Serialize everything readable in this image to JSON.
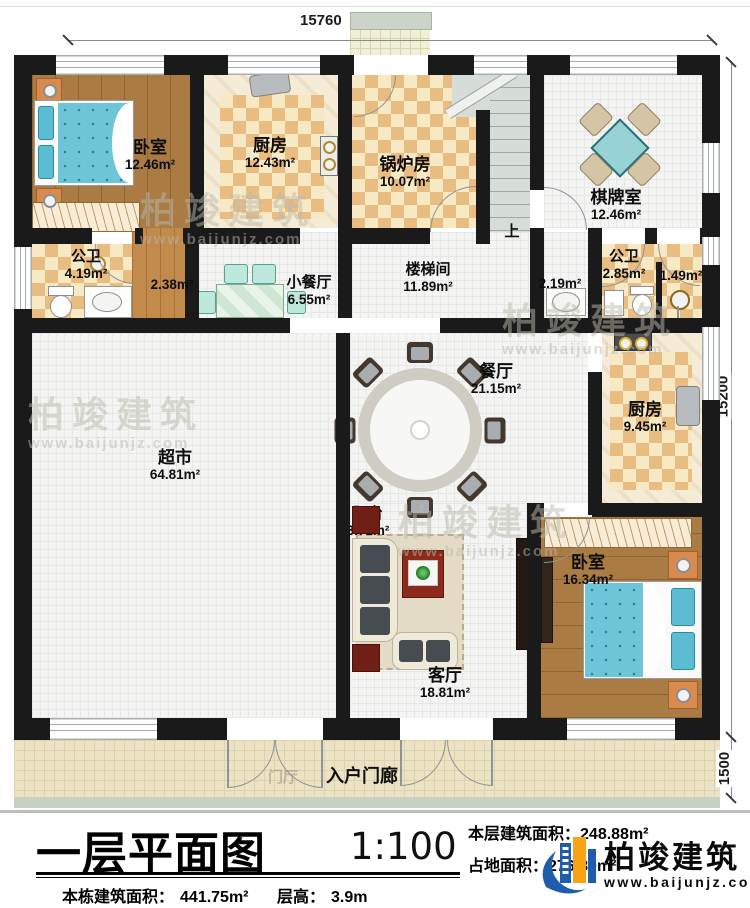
{
  "dims": {
    "top": "15760",
    "right": "15200",
    "porch": "1500"
  },
  "stairs": {
    "up_label": "上"
  },
  "watermark": {
    "brand": "柏竣建筑",
    "url": "www.baijunjz.com"
  },
  "rooms": {
    "bedroom1": {
      "name": "卧室",
      "area": "12.46m²"
    },
    "kitchen1": {
      "name": "厨房",
      "area": "12.43m²"
    },
    "boiler": {
      "name": "锅炉房",
      "area": "10.07m²"
    },
    "chess": {
      "name": "棋牌室",
      "area": "12.46m²"
    },
    "bath1": {
      "name": "公卫",
      "area": "4.19m²"
    },
    "closet": {
      "area": "2.38m²"
    },
    "small_dining": {
      "name": "小餐厅",
      "area": "6.55m²"
    },
    "stair_hall": {
      "name": "楼梯间",
      "area": "11.89m²"
    },
    "wash_nook": {
      "area": "2.19m²"
    },
    "bath2": {
      "name": "公卫",
      "area": "2.85m²"
    },
    "shower_room": {
      "area": "1.49m²"
    },
    "dining": {
      "name": "餐厅",
      "area": "21.15m²"
    },
    "kitchen2": {
      "name": "厨房",
      "area": "9.45m²"
    },
    "supermarket": {
      "name": "超市",
      "area": "64.81m²"
    },
    "living": {
      "name": "客厅",
      "area": "18.81m²"
    },
    "balcony": {
      "name": "阳台",
      "area": "3.71m²"
    },
    "bedroom2": {
      "name": "卧室",
      "area": "16.34m²"
    },
    "porch": {
      "name": "入户门廊"
    },
    "foyer": {
      "name": "门厅"
    }
  },
  "title_block": {
    "title": "一层平面图",
    "scale": "1:100",
    "floor_area_label": "本层建筑面积：",
    "floor_area": "248.88m²",
    "site_area_label": "占地面积：",
    "site_area": "276.80m²",
    "total_area_label": "本栋建筑面积：",
    "total_area": "441.75m²",
    "height_label": "层高：",
    "height": "3.9m"
  },
  "brand": {
    "name": "柏竣建筑",
    "url": "www.baijunjz.com"
  },
  "colors": {
    "wall": "#1a1a1a",
    "accent_blue": "#1f5cab",
    "accent_orange": "#f6a316",
    "bed_teal": "#6ec5d8",
    "table_teal": "#97d2d6"
  }
}
